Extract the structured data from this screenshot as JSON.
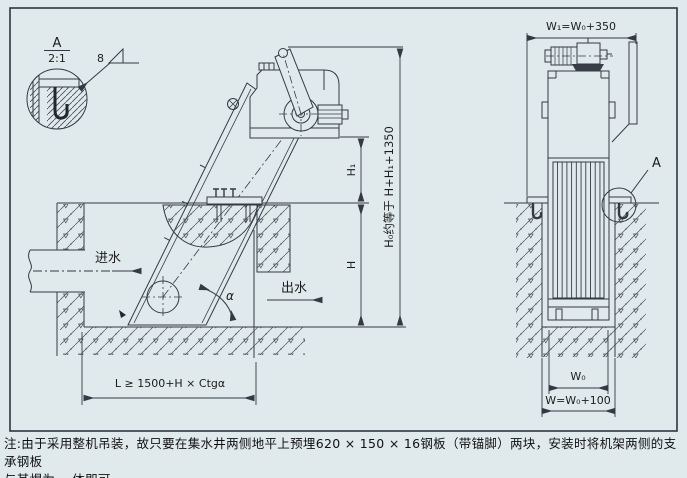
{
  "drawing": {
    "title_hint": "mechanical bar screen installation drawing",
    "detail_view": {
      "label": "A",
      "scale": "2:1",
      "weld_size": "8"
    },
    "side_view": {
      "inlet_label": "进水",
      "outlet_label": "出水",
      "angle_label": "α",
      "dim_h1": "H₁",
      "dim_h": "H",
      "dim_h0": "H₀约等于 H+H₁+1350",
      "dim_l": "L ≥ 1500+H × Ctgα"
    },
    "front_view": {
      "dim_w1": "W₁=W₀+350",
      "dim_w0": "W₀",
      "dim_w": "W=W₀+100",
      "detail_callout": "A"
    },
    "note_line1": "注:由于采用整机吊装，故只要在集水井两侧地平上预埋620 × 150 × 16钢板（带锚脚）两块，安装时将机架两侧的支承钢板",
    "note_line2": "与其焊为一 体即可。",
    "colors": {
      "background": "#e0eaed",
      "line": "#333a44",
      "text": "#1c1c1c"
    }
  }
}
